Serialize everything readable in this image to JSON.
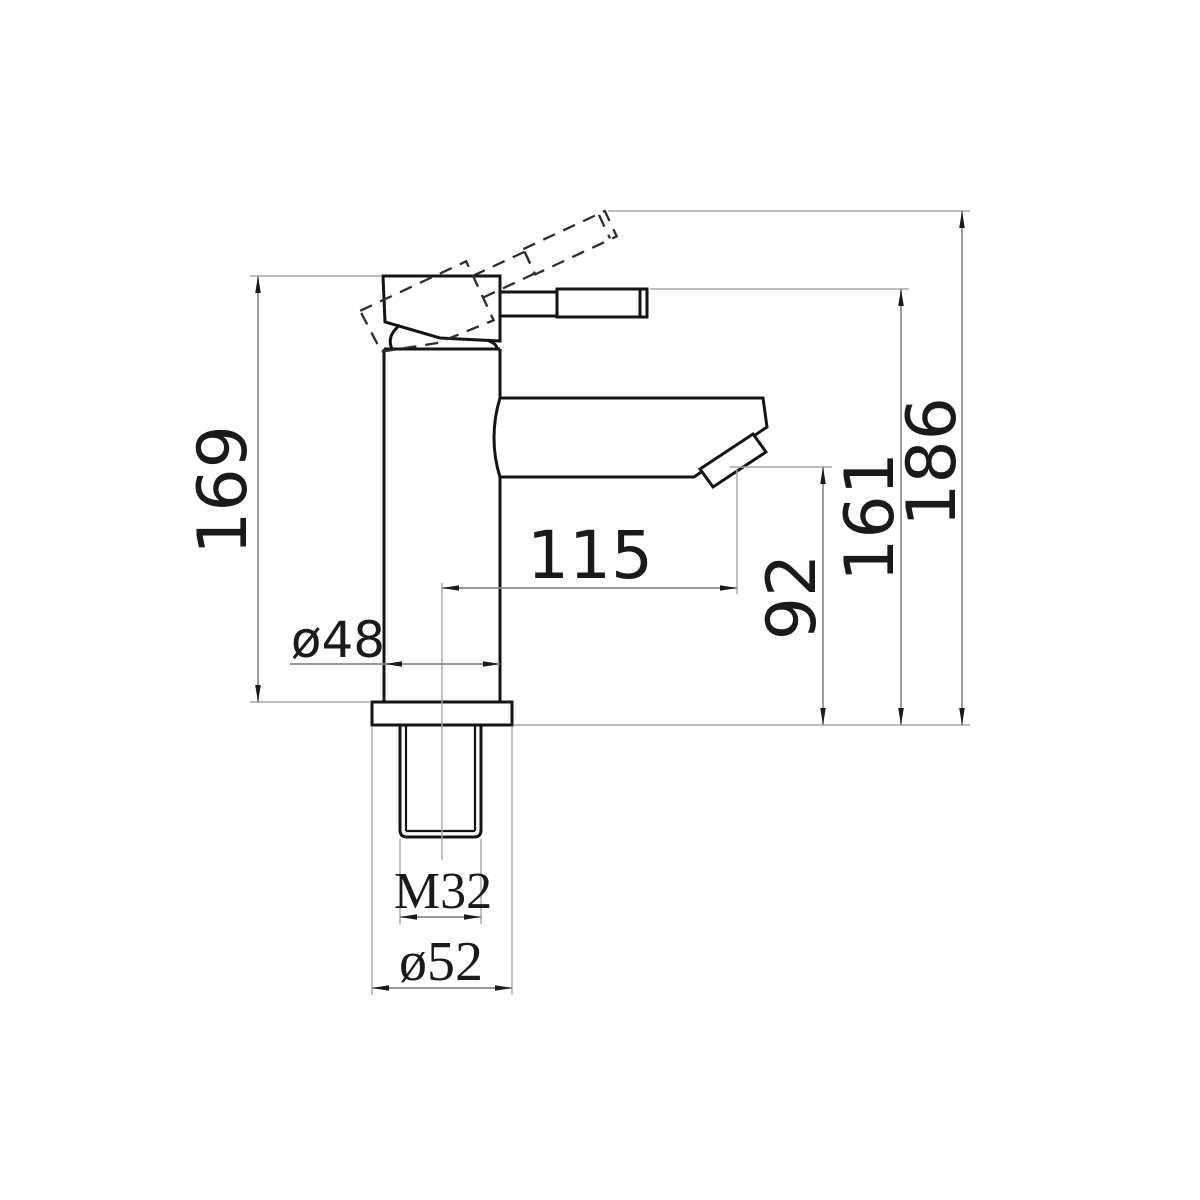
{
  "meta": {
    "drawing_type": "faucet-technical-drawing",
    "background_color": "#ffffff",
    "outline_color": "#141414",
    "dimension_line_color": "#8a8a8a",
    "extension_line_color": "#a6a6a6",
    "text_color": "#1a1a1a"
  },
  "drawing": {
    "dims": {
      "body_height": "169",
      "max_height_handle_raised": "186",
      "overall_height": "161",
      "spout_outlet_height": "92",
      "spout_reach": "115",
      "body_diameter": "ø48",
      "thread_size": "M32",
      "base_diameter": "ø52"
    }
  }
}
